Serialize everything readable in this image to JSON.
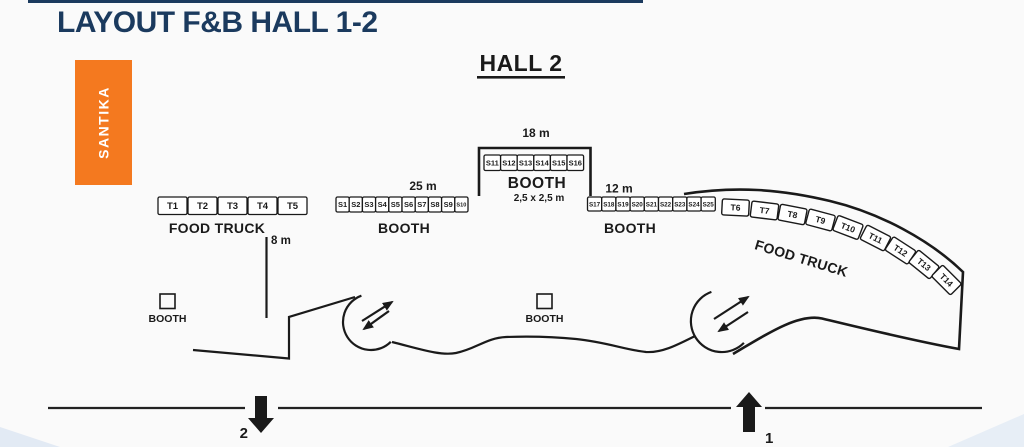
{
  "page": {
    "title": "LAYOUT F&B HALL 1-2"
  },
  "brand": {
    "label": "SANTIKA"
  },
  "hall": {
    "title": "HALL 2"
  },
  "strips": {
    "food_truck_left": {
      "caption": "FOOD TRUCK",
      "labels": [
        "T1",
        "T2",
        "T3",
        "T4",
        "T5"
      ]
    },
    "booth_left": {
      "caption": "BOOTH",
      "dimension": "25 m",
      "labels": [
        "S1",
        "S2",
        "S3",
        "S4",
        "S5",
        "S6",
        "S7",
        "S8",
        "S9",
        "S10"
      ]
    },
    "booth_center": {
      "caption": "BOOTH",
      "dimension": "18 m",
      "unit_size": "2,5 x 2,5 m",
      "labels": [
        "S11",
        "S12",
        "S13",
        "S14",
        "S15",
        "S16"
      ]
    },
    "booth_right": {
      "caption": "BOOTH",
      "dimension": "12 m",
      "labels": [
        "S17",
        "S18",
        "S19",
        "S20",
        "S21",
        "S22",
        "S23",
        "S24",
        "S25"
      ]
    },
    "food_truck_right": {
      "caption": "FOOD TRUCK",
      "labels": [
        "T6",
        "T7",
        "T8",
        "T9",
        "T10",
        "T11",
        "T12",
        "T13",
        "T14"
      ]
    }
  },
  "annotations": {
    "aisle_width": "8 m"
  },
  "standalone_booths": {
    "left_label": "BOOTH",
    "center_label": "BOOTH"
  },
  "gates": {
    "gate_out": "2",
    "gate_in": "1"
  },
  "colors": {
    "accent_orange": "#F4791F",
    "title_navy": "#1B3A5E",
    "line": "#1A1A1A"
  }
}
